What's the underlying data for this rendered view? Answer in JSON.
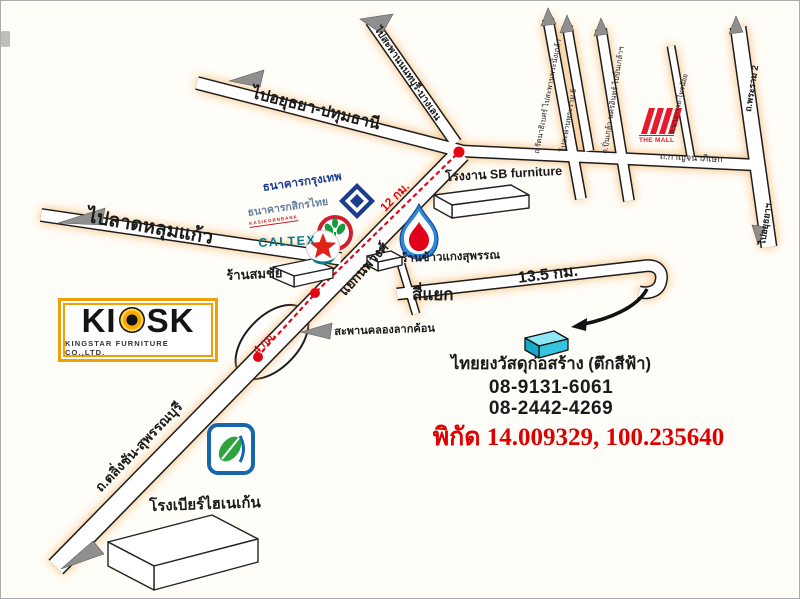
{
  "roads": {
    "to_ayutthaya_pathumthani": "ไปอยุธยา-ปทุมธานี",
    "to_nonthaburi_bridge": "ไปสะพานนนทบุรี-บางเลน",
    "to_lat_lum_kaeo": "ไปลาดหลุมแก้ว",
    "kanchanaphisek": "ถ.กาญจนาภิเษก",
    "ratanathibet": "ถ.รัตนาธิเบศร์ ไปสะพานพระนั่งเกล้า",
    "to_rama5_bridge": "ไปสะพานพระราม 5",
    "pinklao_nakhon_in": "ถ.ปิ่นเกล้า-นครอินทร์ ไปปิ่นเกล้าฯ",
    "bang_kruai_sai_noi": "ถ.บางกรวย-ไทรน้อย",
    "rama2": "ถ.พระราม 2",
    "to_ayutthaya_south": "ไปอยุธยาฯ",
    "taling_chan_suphanburi": "ถ.ตลิ่งชัน-สุพรรณบุรี"
  },
  "junctions": {
    "nopphawong": "แยกนพวงศ์",
    "si_yaek": "สี่แยก",
    "lak_khon_bridge": "สะพานคลองลากค้อน"
  },
  "distances": {
    "junction_to_junction": "12 กม.",
    "bridge_to_junction": "4 กม.",
    "to_destination": "13.5 กม."
  },
  "landmarks": {
    "bangkok_bank": "ธนาคารกรุงเทพ",
    "kasikorn_bank": "ธนาคารกสิกรไทย",
    "kasikorn_sub": "KASIKORNBANK",
    "caltex": "CALTEX",
    "sb_factory": "โรงงาน SB furniture",
    "somchai_shop": "ร้านสมชัย",
    "rice_shop": "ร้านข้าวแกงสุพรรณ",
    "the_mall": "THE MALL",
    "heineken_brewery": "โรงเบียร์ไฮเนเก้น"
  },
  "destination": {
    "name": "ไทยยงวัสดุก่อสร้าง (ตึกสีฟ้า)",
    "phone1": "08-9131-6061",
    "phone2": "08-2442-4269",
    "coordinates": "พิกัด 14.009329, 100.235640"
  },
  "kiosk": {
    "brand_left": "KI",
    "brand_right": "SK",
    "subtitle": "KINGSTAR FURNITURE CO.,LTD."
  },
  "colors": {
    "route_red": "#e30613",
    "coordinates_red": "#dd0000",
    "kiosk_orange": "#f2a007",
    "cyan_building": "#3ec6e0",
    "mall_red": "#e8192c",
    "caltex_teal": "#00788a",
    "bbl_navy": "#1b3c8f",
    "kbank_green": "#169b3e",
    "bangchak_blue": "#1467ad",
    "road_glow": "#f3b260"
  }
}
